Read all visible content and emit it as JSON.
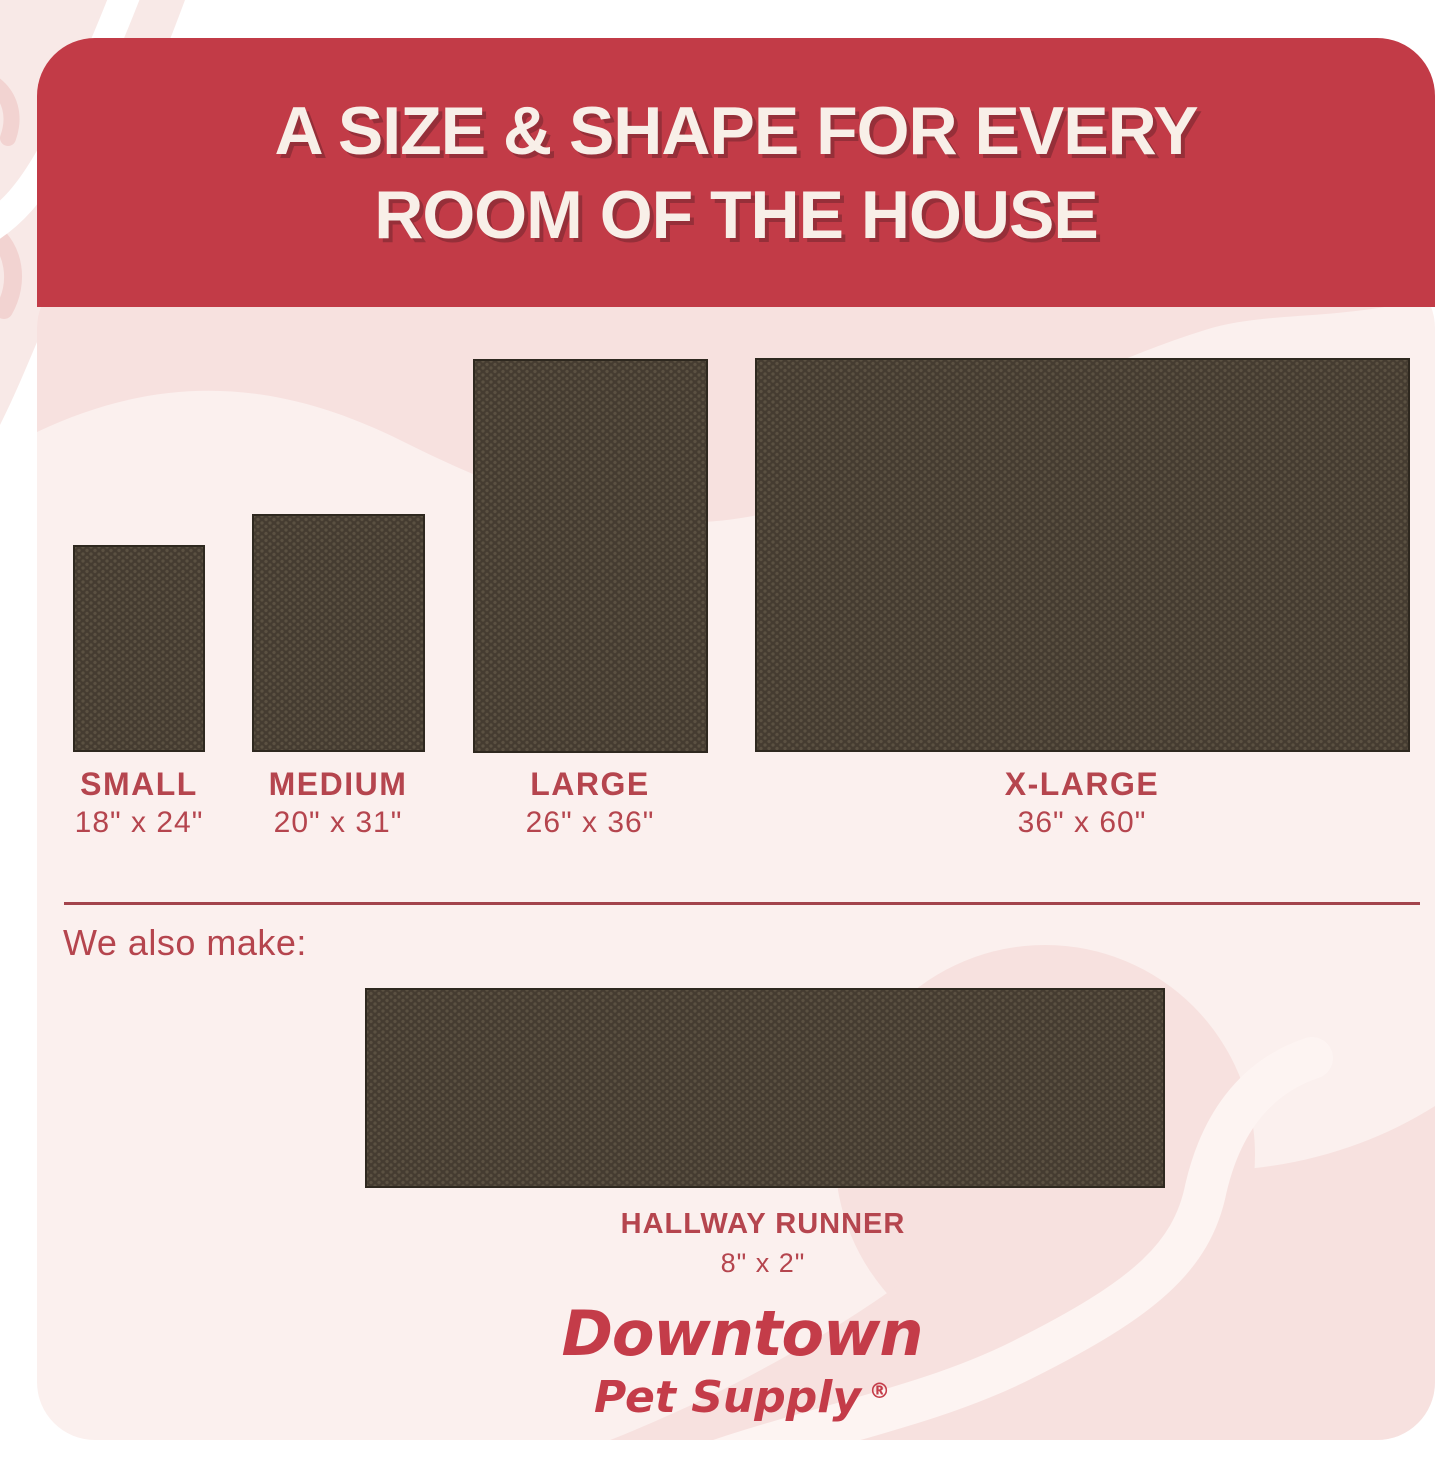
{
  "header": {
    "title_line_1": "A SIZE & SHAPE FOR EVERY",
    "title_line_2": "ROOM OF THE HOUSE"
  },
  "sizes": [
    {
      "name": "SMALL",
      "dimensions": "18\" x 24\""
    },
    {
      "name": "MEDIUM",
      "dimensions": "20\" x 31\""
    },
    {
      "name": "LARGE",
      "dimensions": "26\" x 36\""
    },
    {
      "name": "X-LARGE",
      "dimensions": "36\" x 60\""
    }
  ],
  "also_make": {
    "intro": "We also make:",
    "name": "HALLWAY RUNNER",
    "dimensions": "8\" x 2\""
  },
  "brand": {
    "name": "Downtown",
    "tagline": "Pet Supply",
    "registered_mark": "®"
  },
  "colors": {
    "banner_red": "#c23b47",
    "label_red": "#b5454e",
    "logo_red": "#c43c49",
    "rug_brown": "#453c31",
    "card_pink": "#fbf0ee",
    "accent_pink": "#f7e1df"
  }
}
